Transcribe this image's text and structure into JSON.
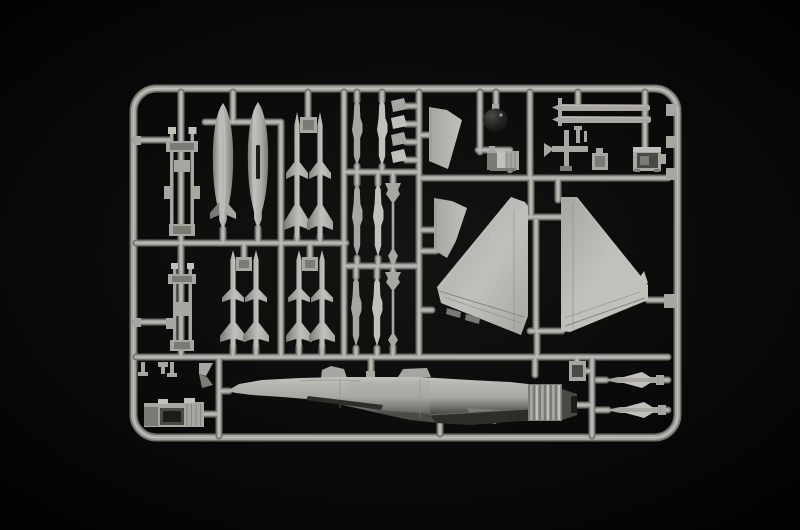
{
  "scene": {
    "description": "Photograph of a grey injection-molded plastic sprue from an aircraft model kit, lying on a black background. The runner frame holds two drop tanks, eight air-to-air missiles, pylon racks, small launch rails and probes, two dark-tinted and light fin blades, a dark nose radome, pitot rods, equipment boxes, two large vertical tail fin halves, a rear fuselage half with afterburner nozzle, a cockpit tub and two small canard wing parts."
  },
  "colors": {
    "bg_center": "#141413",
    "bg_mid": "#0a0a0a",
    "bg_edge": "#020202",
    "sprue_dark": "#6e6d68",
    "sprue_mid": "#a3a29d",
    "sprue_light": "#c9c8c3",
    "part_light": "#c1c0bb",
    "part_mid": "#a7a6a1",
    "part_dark": "#7b7a75",
    "part_deep": "#4a4945",
    "dark_piece": "#1c1c1b",
    "belly_dark": "#2d2d2a",
    "line_dark": "#88877f"
  },
  "parts": {
    "frame": "sprue outer frame",
    "runners": "sprue runners",
    "pylon_rack_top": "stores pylon rack, upper",
    "pylon_rack_bottom": "stores pylon rack, lower",
    "drop_tank_left": "external fuel tank, left",
    "drop_tank_right": "external fuel tank, right",
    "missile": "air-to-air missile",
    "missile_block": "missile mounting block",
    "launch_rail": "missile launch rail",
    "small_fin": "small stabilizer fin",
    "probe": "probe antenna mast",
    "fin_blade_upper": "fin blade, upper",
    "fin_blade_lower": "fin blade, lower",
    "radome": "dark nose radome",
    "seat": "ejection seat",
    "pitot_rod": "pitot probe rod",
    "gear_part": "landing gear part",
    "pin_part": "small pin part",
    "small_box": "avionics box",
    "equipment_box": "equipment box",
    "tail_fin_left": "vertical tail half, left",
    "tail_fin_right": "vertical tail half, right",
    "fuselage": "rear fuselage half with exhaust nozzle",
    "cockpit_tub": "cockpit tub",
    "intake_part": "intake lip part",
    "fitting": "small fitting",
    "canard_1": "canard wing part 1",
    "canard_2": "canard wing part 2",
    "exhaust_box": "nozzle ring part",
    "gate_tab": "sprue gate tab"
  }
}
